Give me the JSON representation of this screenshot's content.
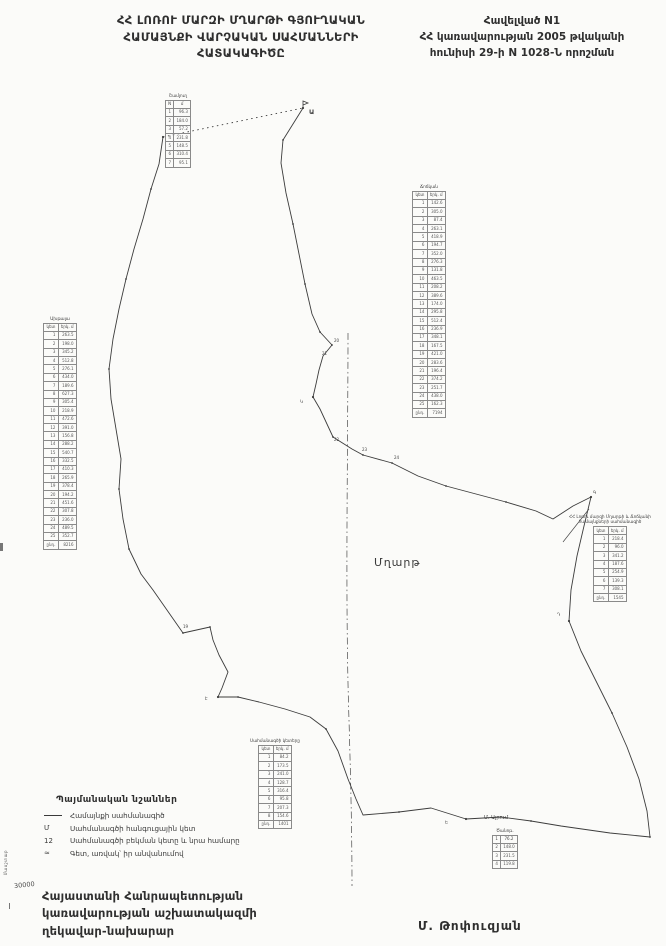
{
  "header": {
    "title_lines": [
      "ՀՀ ԼՈՌՈՒ ՄԱՐԶԻ ՄՂԱՐԹԻ ԳՅՈՒՂԱԿԱՆ",
      "ՀԱՄԱՅՆՔԻ ՎԱՐՉԱԿԱՆ ՍԱՀՄԱՆՆԵՐԻ",
      "ՀԱՏԱԿԱԳԻԾԸ"
    ],
    "appendix_lines": [
      "Հավելված N1",
      "ՀՀ կառավարության 2005 թվականի",
      "հունիսի 29-ի N 1028-Ն որոշման"
    ]
  },
  "map": {
    "center_label": "Մղարթ",
    "neighbor_label": "Մ. Այրում",
    "point_labels": [
      "Ա",
      "Գ",
      "Դ",
      "Ե",
      "Է",
      "Կ",
      "19",
      "20",
      "21",
      "22",
      "23",
      "24"
    ],
    "scale_vertical": "Մասշտաբ",
    "scale_note": "30000"
  },
  "tables": {
    "top": {
      "title": "Շամլուղ",
      "rows": [
        [
          "N",
          "մ"
        ],
        [
          "1",
          "96.3"
        ],
        [
          "2",
          "184.0"
        ],
        [
          "3",
          "57.2"
        ],
        [
          "4",
          "231.8"
        ],
        [
          "5",
          "148.5"
        ],
        [
          "6",
          "310.4"
        ],
        [
          "7",
          "95.1"
        ]
      ]
    },
    "left": {
      "title": "Ախթալա",
      "rows": [
        [
          "կետ",
          "երկ. մ"
        ],
        [
          "1",
          "263.5"
        ],
        [
          "2",
          "198.0"
        ],
        [
          "3",
          "345.2"
        ],
        [
          "4",
          "512.8"
        ],
        [
          "5",
          "276.1"
        ],
        [
          "6",
          "434.0"
        ],
        [
          "7",
          "189.6"
        ],
        [
          "8",
          "627.3"
        ],
        [
          "9",
          "305.4"
        ],
        [
          "10",
          "218.9"
        ],
        [
          "11",
          "472.6"
        ],
        [
          "12",
          "391.0"
        ],
        [
          "13",
          "156.8"
        ],
        [
          "14",
          "288.2"
        ],
        [
          "15",
          "540.7"
        ],
        [
          "16",
          "332.5"
        ],
        [
          "17",
          "410.3"
        ],
        [
          "18",
          "265.9"
        ],
        [
          "19",
          "378.4"
        ],
        [
          "20",
          "194.2"
        ],
        [
          "21",
          "451.6"
        ],
        [
          "22",
          "307.8"
        ],
        [
          "23",
          "236.0"
        ],
        [
          "24",
          "489.5"
        ],
        [
          "25",
          "352.7"
        ],
        [
          "ընդ.",
          "8216"
        ]
      ]
    },
    "right": {
      "title": "Ճոճկան",
      "rows": [
        [
          "կետ",
          "երկ. մ"
        ],
        [
          "1",
          "142.6"
        ],
        [
          "2",
          "305.0"
        ],
        [
          "3",
          "87.4"
        ],
        [
          "4",
          "263.1"
        ],
        [
          "5",
          "418.9"
        ],
        [
          "6",
          "194.7"
        ],
        [
          "7",
          "352.0"
        ],
        [
          "8",
          "276.3"
        ],
        [
          "9",
          "131.8"
        ],
        [
          "10",
          "463.5"
        ],
        [
          "11",
          "208.2"
        ],
        [
          "12",
          "389.6"
        ],
        [
          "13",
          "174.0"
        ],
        [
          "14",
          "295.8"
        ],
        [
          "15",
          "512.4"
        ],
        [
          "16",
          "236.9"
        ],
        [
          "17",
          "348.1"
        ],
        [
          "18",
          "167.5"
        ],
        [
          "19",
          "421.0"
        ],
        [
          "20",
          "283.6"
        ],
        [
          "21",
          "196.4"
        ],
        [
          "22",
          "374.2"
        ],
        [
          "23",
          "251.7"
        ],
        [
          "24",
          "438.0"
        ],
        [
          "25",
          "162.3"
        ],
        [
          "ընդ.",
          "7194"
        ]
      ]
    },
    "midright": {
      "title_lines": [
        "ՀՀ Լոռու մարզի Մղարթի և Ճոճկանի",
        "համայնքների սահմանագիծ"
      ],
      "rows": [
        [
          "կետ",
          "երկ. մ"
        ],
        [
          "1",
          "218.4"
        ],
        [
          "2",
          "96.0"
        ],
        [
          "3",
          "341.2"
        ],
        [
          "4",
          "187.6"
        ],
        [
          "5",
          "254.9"
        ],
        [
          "6",
          "139.3"
        ],
        [
          "7",
          "308.1"
        ],
        [
          "ընդ.",
          "1545"
        ]
      ]
    },
    "bottomcenter": {
      "title": "Սահմանագծի կետերը",
      "rows": [
        [
          "կետ",
          "երկ. մ"
        ],
        [
          "1",
          "84.2"
        ],
        [
          "2",
          "173.5"
        ],
        [
          "3",
          "241.0"
        ],
        [
          "4",
          "128.7"
        ],
        [
          "5",
          "316.4"
        ],
        [
          "6",
          "95.8"
        ],
        [
          "7",
          "207.3"
        ],
        [
          "8",
          "154.6"
        ],
        [
          "ընդ.",
          "1401"
        ]
      ]
    },
    "bottomright": {
      "title": "Ծանոթ.",
      "rows": [
        [
          "1",
          "76.2"
        ],
        [
          "2",
          "148.0"
        ],
        [
          "3",
          "231.5"
        ],
        [
          "4",
          "119.8"
        ]
      ]
    }
  },
  "legend": {
    "title": "Պայմանական նշաններ",
    "items": [
      {
        "symbol": "line",
        "label": "Համայնքի սահմանագիծ"
      },
      {
        "symbol": "Մ",
        "label": "Սահմանագծի հանգուցային կետ"
      },
      {
        "symbol": "12",
        "label": "Սահմանագծի բեկման կետը և նրա համարը"
      },
      {
        "symbol": "≈",
        "label": "Գետ, առվակ՝ իր անվանումով"
      }
    ]
  },
  "footer": {
    "left_lines": [
      "Հայաստանի Հանրապետության",
      "կառավարության աշխատակազմի",
      "ղեկավար-նախարար"
    ],
    "signature": "Մ. Թոփուզյան"
  },
  "colors": {
    "ink": "#2f2f2f",
    "paper": "#fbfbf9",
    "boundary": "#3c3c3c"
  }
}
